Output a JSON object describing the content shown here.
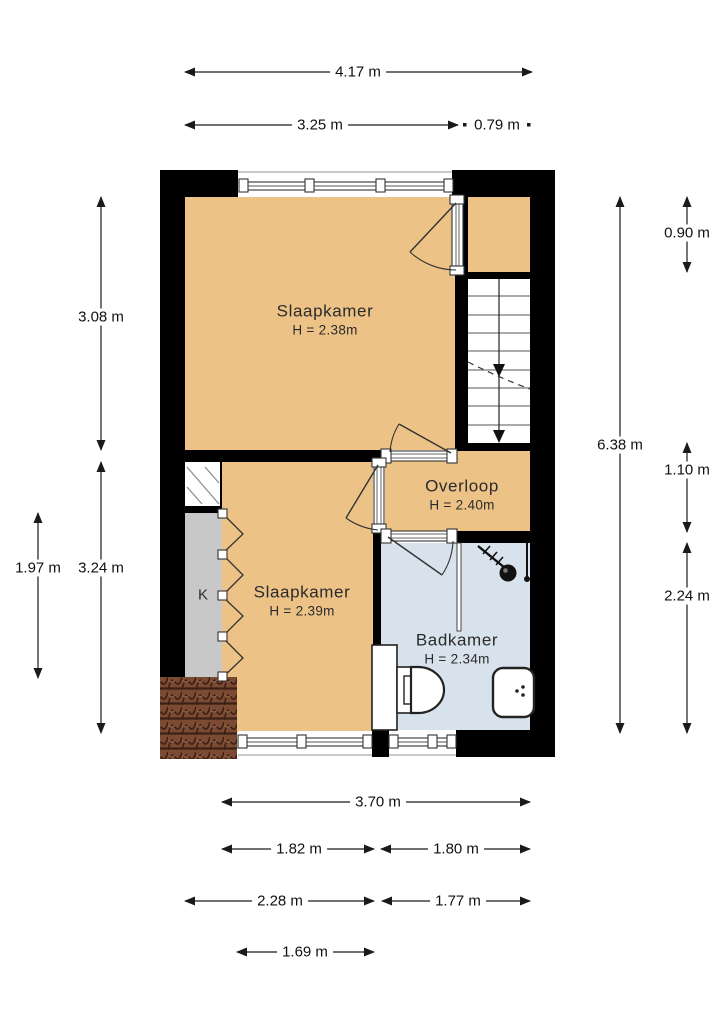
{
  "title": "Floor plan – first floor (verdieping)",
  "rooms": [
    {
      "id": "slaapkamer-1",
      "name": "Slaapkamer",
      "ceiling_height": "H = 2.38m"
    },
    {
      "id": "slaapkamer-2",
      "name": "Slaapkamer",
      "ceiling_height": "H = 2.39m"
    },
    {
      "id": "overloop",
      "name": "Overloop",
      "ceiling_height": "H = 2.40m"
    },
    {
      "id": "badkamer",
      "name": "Badkamer",
      "ceiling_height": "H = 2.34m"
    },
    {
      "id": "kast",
      "name": "K"
    }
  ],
  "dimensions": {
    "top_total": "4.17 m",
    "top_left": "3.25 m",
    "top_right": "0.79 m",
    "left_upper": "3.08 m",
    "left_lower": "3.24 m",
    "left_closet": "1.97 m",
    "right_total": "6.38 m",
    "right_top": "0.90 m",
    "right_mid": "1.10 m",
    "right_bottom": "2.24 m",
    "bottom_row1_total": "3.70 m",
    "bottom_row2_left": "1.82 m",
    "bottom_row2_right": "1.80 m",
    "bottom_row3_left": "2.28 m",
    "bottom_row3_right": "1.77 m",
    "bottom_row4_window": "1.69 m"
  },
  "features": [
    "stairs-down",
    "shower",
    "toilet",
    "washbasin",
    "folding-closet-doors",
    "roof-tiles",
    "windows",
    "hinged-doors"
  ],
  "colors": {
    "page-bg": "#ffffff",
    "wall": "#000000",
    "floor-room": "#ecc287",
    "floor-bath": "#d7e2ec",
    "floor-closet": "#c8c8c8",
    "stairs": "#ffffff",
    "tile-base": "#7b4a33",
    "tile-dark": "#3c2014",
    "tile-light": "#8f5c41",
    "dim-text": "#111111",
    "room-text": "#2b2b2b",
    "line": "#1a1a1a"
  }
}
